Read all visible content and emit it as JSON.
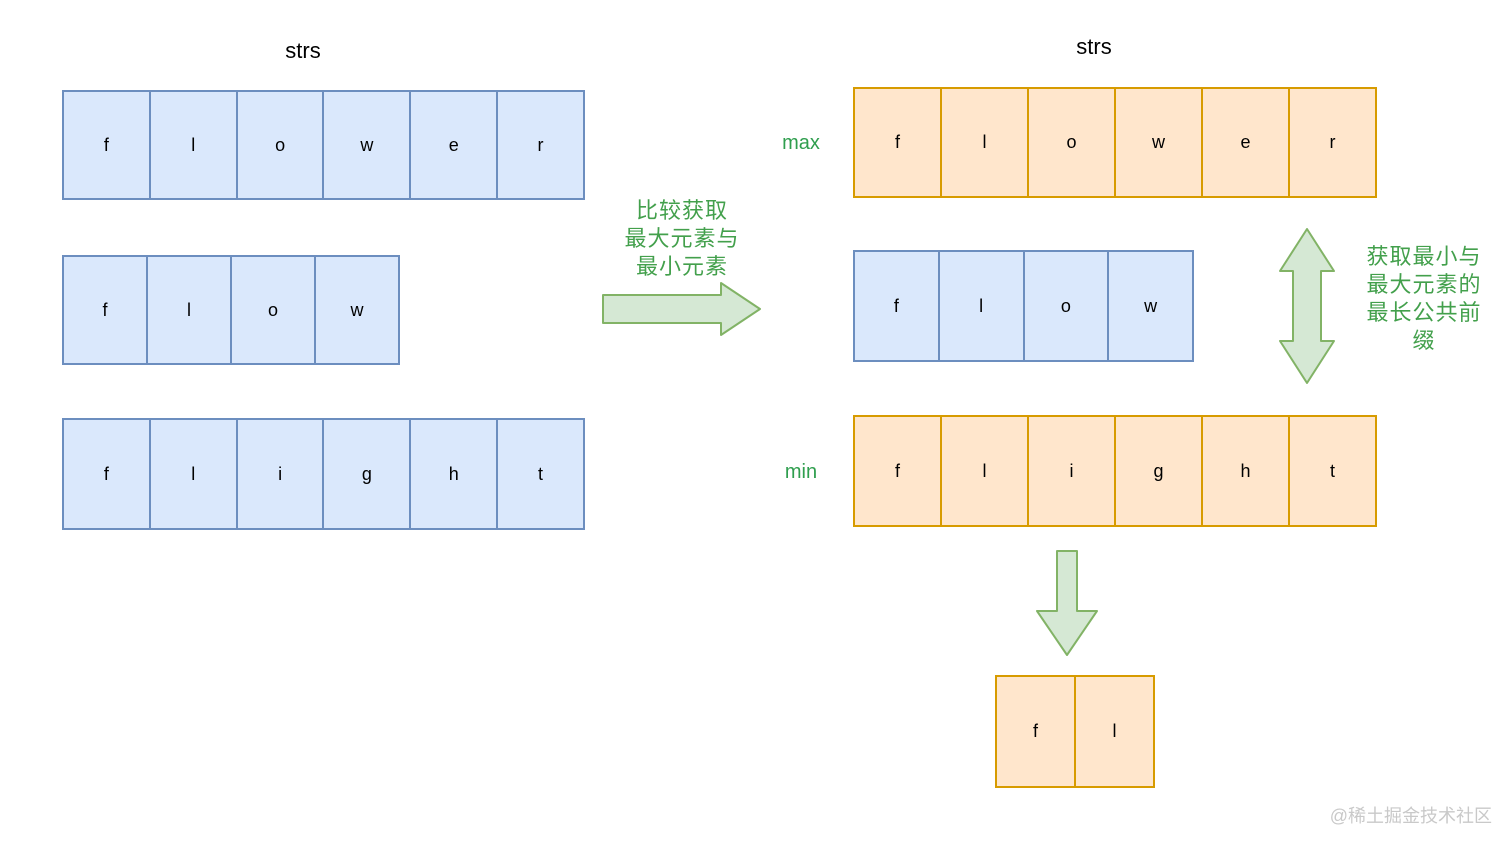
{
  "left": {
    "title": "strs",
    "arrays": [
      {
        "name": "flower",
        "cells": [
          "f",
          "l",
          "o",
          "w",
          "e",
          "r"
        ]
      },
      {
        "name": "flow",
        "cells": [
          "f",
          "l",
          "o",
          "w"
        ]
      },
      {
        "name": "flight",
        "cells": [
          "f",
          "l",
          "i",
          "g",
          "h",
          "t"
        ]
      }
    ]
  },
  "middle": {
    "caption_lines": [
      "比较获取",
      "最大元素与",
      "最小元素"
    ]
  },
  "right": {
    "title": "strs",
    "max_label": "max",
    "min_label": "min",
    "arrays": [
      {
        "name": "flower",
        "role": "max",
        "cells": [
          "f",
          "l",
          "o",
          "w",
          "e",
          "r"
        ]
      },
      {
        "name": "flow",
        "role": "middle",
        "cells": [
          "f",
          "l",
          "o",
          "w"
        ]
      },
      {
        "name": "flight",
        "role": "min",
        "cells": [
          "f",
          "l",
          "i",
          "g",
          "h",
          "t"
        ]
      }
    ],
    "caption_lines": [
      "获取最小与",
      "最大元素的",
      "最长公共前",
      "缀"
    ],
    "result": {
      "name": "fl",
      "cells": [
        "f",
        "l"
      ]
    }
  },
  "icons": {
    "right_arrow": "block-arrow-right",
    "vertical_arrow": "block-arrow-vertical-double",
    "down_arrow": "block-arrow-down"
  },
  "colors": {
    "blue_fill": "#dae8fc",
    "blue_stroke": "#6c8ebf",
    "orange_fill": "#ffe6cc",
    "orange_stroke": "#d79b00",
    "arrow_fill": "#d5e8d4",
    "arrow_stroke": "#82b366",
    "green_text": "#43a04c",
    "watermark_gray": "#c9c9c9"
  },
  "watermark": "@稀土掘金技术社区"
}
